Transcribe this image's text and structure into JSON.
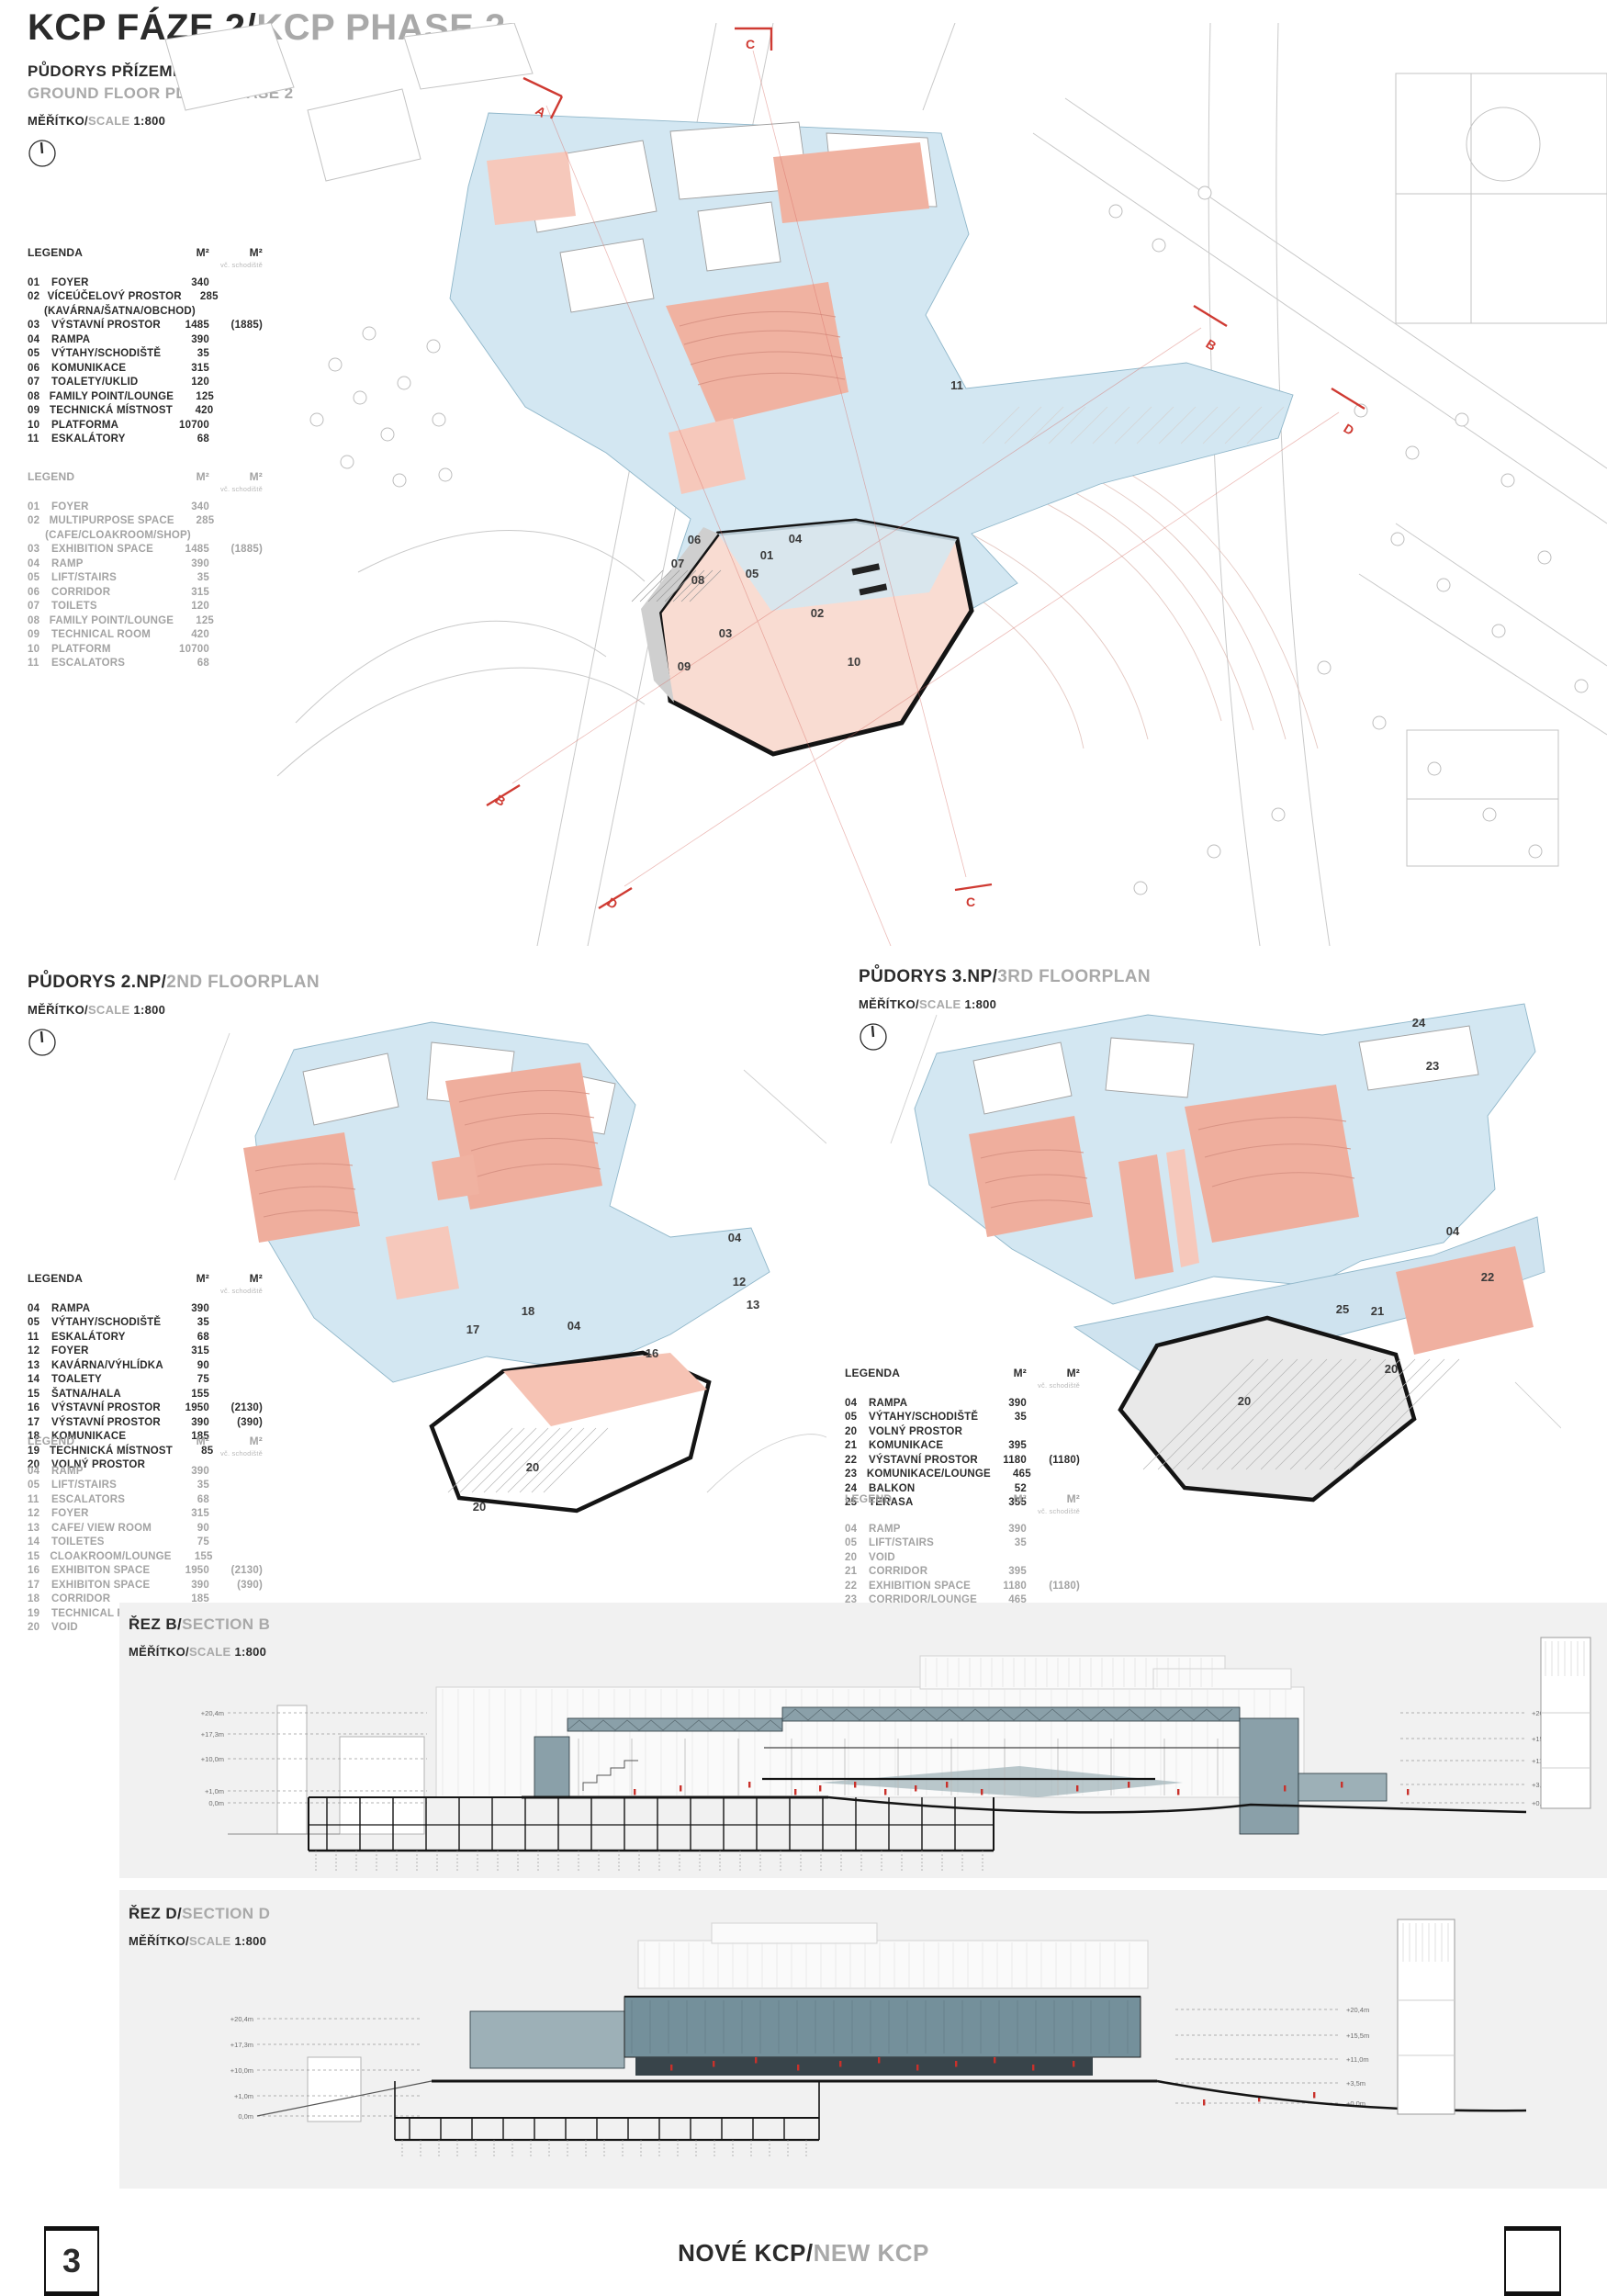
{
  "board": {
    "title_primary": "KCP FÁZE 2/",
    "title_secondary": "KCP PHASE 2",
    "footer": {
      "page_number": "3",
      "title_primary": "NOVÉ KCP/",
      "title_secondary": "NEW KCP"
    }
  },
  "scale": {
    "cs": "MĚŘÍTKO/",
    "en": "SCALE",
    "value": "1:800"
  },
  "panels": {
    "ground": {
      "title_cs": "PŮDORYS PŘÍZEMÍ - FÁZE 2",
      "title_en": "GROUND FLOOR PLAN - PHASE 2"
    },
    "np2": {
      "title_cs": "PŮDORYS 2.NP/",
      "title_en": "2ND FLOORPLAN"
    },
    "np3": {
      "title_cs": "PŮDORYS 3.NP/",
      "title_en": "3RD FLOORPLAN"
    },
    "section_b": {
      "title_cs": "ŘEZ B/",
      "title_en": "SECTION B"
    },
    "section_d": {
      "title_cs": "ŘEZ D/",
      "title_en": "SECTION D"
    }
  },
  "legends": {
    "ground_cs": {
      "title": "LEGENDA",
      "m2_a": "M²",
      "m2_b": "M²",
      "m2_sub": "vč. schodiště",
      "items": [
        {
          "n": "01",
          "label": "FOYER",
          "v1": "340"
        },
        {
          "n": "02",
          "label": "VÍCEÚČELOVÝ PROSTOR",
          "note": "(KAVÁRNA/ŠATNA/OBCHOD)",
          "v1": "285"
        },
        {
          "n": "03",
          "label": "VÝSTAVNÍ PROSTOR",
          "v1": "1485",
          "v2": "(1885)"
        },
        {
          "n": "04",
          "label": "RAMPA",
          "v1": "390"
        },
        {
          "n": "05",
          "label": "VÝTAHY/SCHODIŠTĚ",
          "v1": "35"
        },
        {
          "n": "06",
          "label": "KOMUNIKACE",
          "v1": "315"
        },
        {
          "n": "07",
          "label": "TOALETY/UKLID",
          "v1": "120"
        },
        {
          "n": "08",
          "label": "FAMILY POINT/LOUNGE",
          "v1": "125"
        },
        {
          "n": "09",
          "label": "TECHNICKÁ MÍSTNOST",
          "v1": "420"
        },
        {
          "n": "10",
          "label": "PLATFORMA",
          "v1": "10700"
        },
        {
          "n": "11",
          "label": "ESKALÁTORY",
          "v1": "68"
        }
      ]
    },
    "ground_en": {
      "title": "LEGEND",
      "m2_a": "M²",
      "m2_b": "M²",
      "m2_sub": "vč. schodiště",
      "items": [
        {
          "n": "01",
          "label": "FOYER",
          "v1": "340"
        },
        {
          "n": "02",
          "label": "MULTIPURPOSE SPACE",
          "note": "(CAFE/CLOAKROOM/SHOP)",
          "v1": "285"
        },
        {
          "n": "03",
          "label": "EXHIBITION SPACE",
          "v1": "1485",
          "v2": "(1885)"
        },
        {
          "n": "04",
          "label": "RAMP",
          "v1": "390"
        },
        {
          "n": "05",
          "label": "LIFT/STAIRS",
          "v1": "35"
        },
        {
          "n": "06",
          "label": "CORRIDOR",
          "v1": "315"
        },
        {
          "n": "07",
          "label": "TOILETS",
          "v1": "120"
        },
        {
          "n": "08",
          "label": "FAMILY POINT/LOUNGE",
          "v1": "125"
        },
        {
          "n": "09",
          "label": "TECHNICAL ROOM",
          "v1": "420"
        },
        {
          "n": "10",
          "label": "PLATFORM",
          "v1": "10700"
        },
        {
          "n": "11",
          "label": "ESCALATORS",
          "v1": "68"
        }
      ]
    },
    "np2_cs": {
      "title": "LEGENDA",
      "m2_a": "M²",
      "m2_b": "M²",
      "m2_sub": "vč. schodiště",
      "items": [
        {
          "n": "04",
          "label": "RAMPA",
          "v1": "390"
        },
        {
          "n": "05",
          "label": "VÝTAHY/SCHODIŠTĚ",
          "v1": "35"
        },
        {
          "n": "11",
          "label": "ESKALÁTORY",
          "v1": "68"
        },
        {
          "n": "12",
          "label": "FOYER",
          "v1": "315"
        },
        {
          "n": "13",
          "label": "KAVÁRNA/VÝHLÍDKA",
          "v1": "90"
        },
        {
          "n": "14",
          "label": "TOALETY",
          "v1": "75"
        },
        {
          "n": "15",
          "label": "ŠATNA/HALA",
          "v1": "155"
        },
        {
          "n": "16",
          "label": "VÝSTAVNÍ PROSTOR",
          "v1": "1950",
          "v2": "(2130)"
        },
        {
          "n": "17",
          "label": "VÝSTAVNÍ PROSTOR",
          "v1": "390",
          "v2": "(390)"
        },
        {
          "n": "18",
          "label": "KOMUNIKACE",
          "v1": "185"
        },
        {
          "n": "19",
          "label": "TECHNICKÁ MÍSTNOST",
          "v1": "85"
        },
        {
          "n": "20",
          "label": "VOLNÝ PROSTOR"
        }
      ]
    },
    "np2_en": {
      "title": "LEGEND",
      "m2_a": "M²",
      "m2_b": "M²",
      "m2_sub": "vč. schodiště",
      "items": [
        {
          "n": "04",
          "label": "RAMP",
          "v1": "390"
        },
        {
          "n": "05",
          "label": "LIFT/STAIRS",
          "v1": "35"
        },
        {
          "n": "11",
          "label": "ESCALATORS",
          "v1": "68"
        },
        {
          "n": "12",
          "label": "FOYER",
          "v1": "315"
        },
        {
          "n": "13",
          "label": "CAFE/ VIEW ROOM",
          "v1": "90"
        },
        {
          "n": "14",
          "label": "TOILETES",
          "v1": "75"
        },
        {
          "n": "15",
          "label": "CLOAKROOM/LOUNGE",
          "v1": "155"
        },
        {
          "n": "16",
          "label": "EXHIBITON SPACE",
          "v1": "1950",
          "v2": "(2130)"
        },
        {
          "n": "17",
          "label": "EXHIBITON SPACE",
          "v1": "390",
          "v2": "(390)"
        },
        {
          "n": "18",
          "label": "CORRIDOR",
          "v1": "185"
        },
        {
          "n": "19",
          "label": "TECHNICAL ROOM",
          "v1": "85"
        },
        {
          "n": "20",
          "label": "VOID"
        }
      ]
    },
    "np3_cs": {
      "title": "LEGENDA",
      "m2_a": "M²",
      "m2_b": "M²",
      "m2_sub": "vč. schodiště",
      "items": [
        {
          "n": "04",
          "label": "RAMPA",
          "v1": "390"
        },
        {
          "n": "05",
          "label": "VÝTAHY/SCHODIŠTĚ",
          "v1": "35"
        },
        {
          "n": "20",
          "label": "VOLNÝ PROSTOR"
        },
        {
          "n": "21",
          "label": "KOMUNIKACE",
          "v1": "395"
        },
        {
          "n": "22",
          "label": "VÝSTAVNÍ PROSTOR",
          "v1": "1180",
          "v2": "(1180)"
        },
        {
          "n": "23",
          "label": "KOMUNIKACE/LOUNGE",
          "v1": "465"
        },
        {
          "n": "24",
          "label": "BALKON",
          "v1": "52"
        },
        {
          "n": "25",
          "label": "TERASA",
          "v1": "355"
        }
      ]
    },
    "np3_en": {
      "title": "LEGEND",
      "m2_a": "M²",
      "m2_b": "M²",
      "m2_sub": "vč. schodiště",
      "items": [
        {
          "n": "04",
          "label": "RAMP",
          "v1": "390"
        },
        {
          "n": "05",
          "label": "LIFT/STAIRS",
          "v1": "35"
        },
        {
          "n": "20",
          "label": "VOID"
        },
        {
          "n": "21",
          "label": "CORRIDOR",
          "v1": "395"
        },
        {
          "n": "22",
          "label": "EXHIBITION SPACE",
          "v1": "1180",
          "v2": "(1180)"
        },
        {
          "n": "23",
          "label": "CORRIDOR/LOUNGE",
          "v1": "465"
        },
        {
          "n": "24",
          "label": "BALCONY",
          "v1": "52"
        },
        {
          "n": "25",
          "label": "TERRASE",
          "v1": "355"
        }
      ]
    }
  },
  "plan_labels": {
    "ground": {
      "l01": "01",
      "l02": "02",
      "l03": "03",
      "l04": "04",
      "l05": "05",
      "l06": "06",
      "l07": "07",
      "l08": "08",
      "l09": "09",
      "l10": "10",
      "l11": "11"
    },
    "np2": {
      "l04": "04",
      "l12": "12",
      "l13": "13",
      "l16": "16",
      "l17": "17",
      "l18": "18",
      "l20": "20"
    },
    "np3": {
      "l04": "04",
      "l20": "20",
      "l21": "21",
      "l22": "22",
      "l23": "23",
      "l24": "24",
      "l25": "25"
    }
  },
  "markers": {
    "a": "A",
    "b": "B",
    "c": "C",
    "d": "D"
  },
  "sections": {
    "levels_left": [
      "+20,4m",
      "+17,3m",
      "+10,0m",
      "+1,0m",
      "0,0m"
    ],
    "levels_right": [
      "+20,4m",
      "+15,5m",
      "+11,0m",
      "+3,5m",
      "+0,0m"
    ]
  },
  "colors": {
    "plan_blue": "#d3e7f2",
    "salmon": "#f0b2a1",
    "salmon_light": "#f6c8bb",
    "marker_red": "#cf3a32",
    "section_teal": "#8aa0a9",
    "panel_gray": "#f1f1f1"
  }
}
